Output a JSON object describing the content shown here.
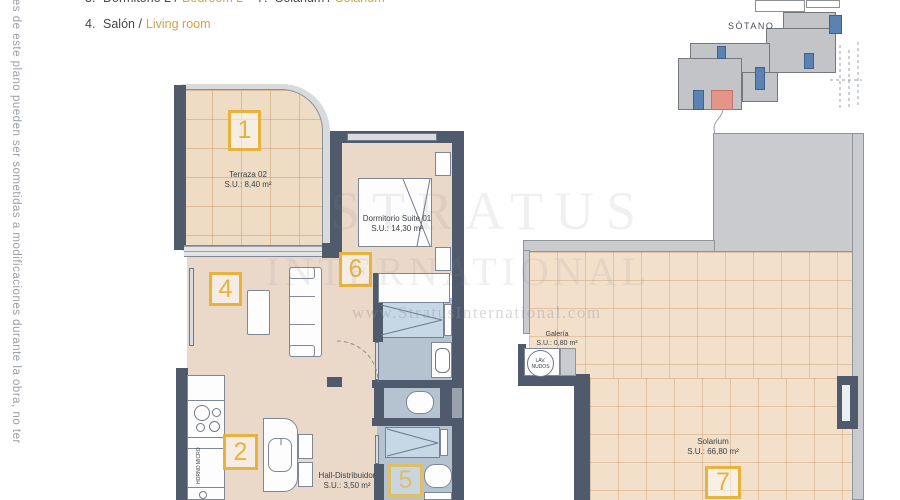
{
  "legend": {
    "row1_left_num": "3.",
    "row1_left_es": "Dormitorio 2 /",
    "row1_left_en": "Bedroom 2",
    "row1_right_num": "7.",
    "row1_right_es": "Solarium /",
    "row1_right_en": "Solarium",
    "row2_num": "4.",
    "row2_es": "Salón /",
    "row2_en": "Living room"
  },
  "side_note": "nes de este plano pueden ser sometidas a modificaciones durante la obra, no ter",
  "watermark": {
    "big_top": "STRATUS",
    "big_bottom": "INTERNATIONAL",
    "url": "www.StratusInternational.com"
  },
  "key_plan": {
    "title": "SÓTANO"
  },
  "plan": {
    "terraza": {
      "number": "1",
      "name": "Terraza 02",
      "area": "S.U.: 8,40 m²"
    },
    "salon": {
      "number": "4"
    },
    "cocina": {
      "number": "2",
      "appliance": "HORNO MICRO"
    },
    "dormitorio": {
      "number": "6",
      "name": "Dormitorio Suite 01",
      "area": "S.U.: 14,30 m²"
    },
    "hall": {
      "name": "Hall-Distribuidor",
      "area": "S.U.: 3,50 m²"
    },
    "bano": {
      "number": "5"
    },
    "galeria": {
      "name": "Galería",
      "area": "S.U.: 0,80 m²",
      "appliance": "LAV. NUDOS"
    },
    "solarium": {
      "number": "7",
      "name": "Solarium",
      "area": "S.U.: 66,80 m²"
    }
  },
  "colors": {
    "wall": "#4f5b6d",
    "accent": "#e7b23e",
    "floor": "#ead9c9",
    "bath": "#b5c3d1"
  }
}
